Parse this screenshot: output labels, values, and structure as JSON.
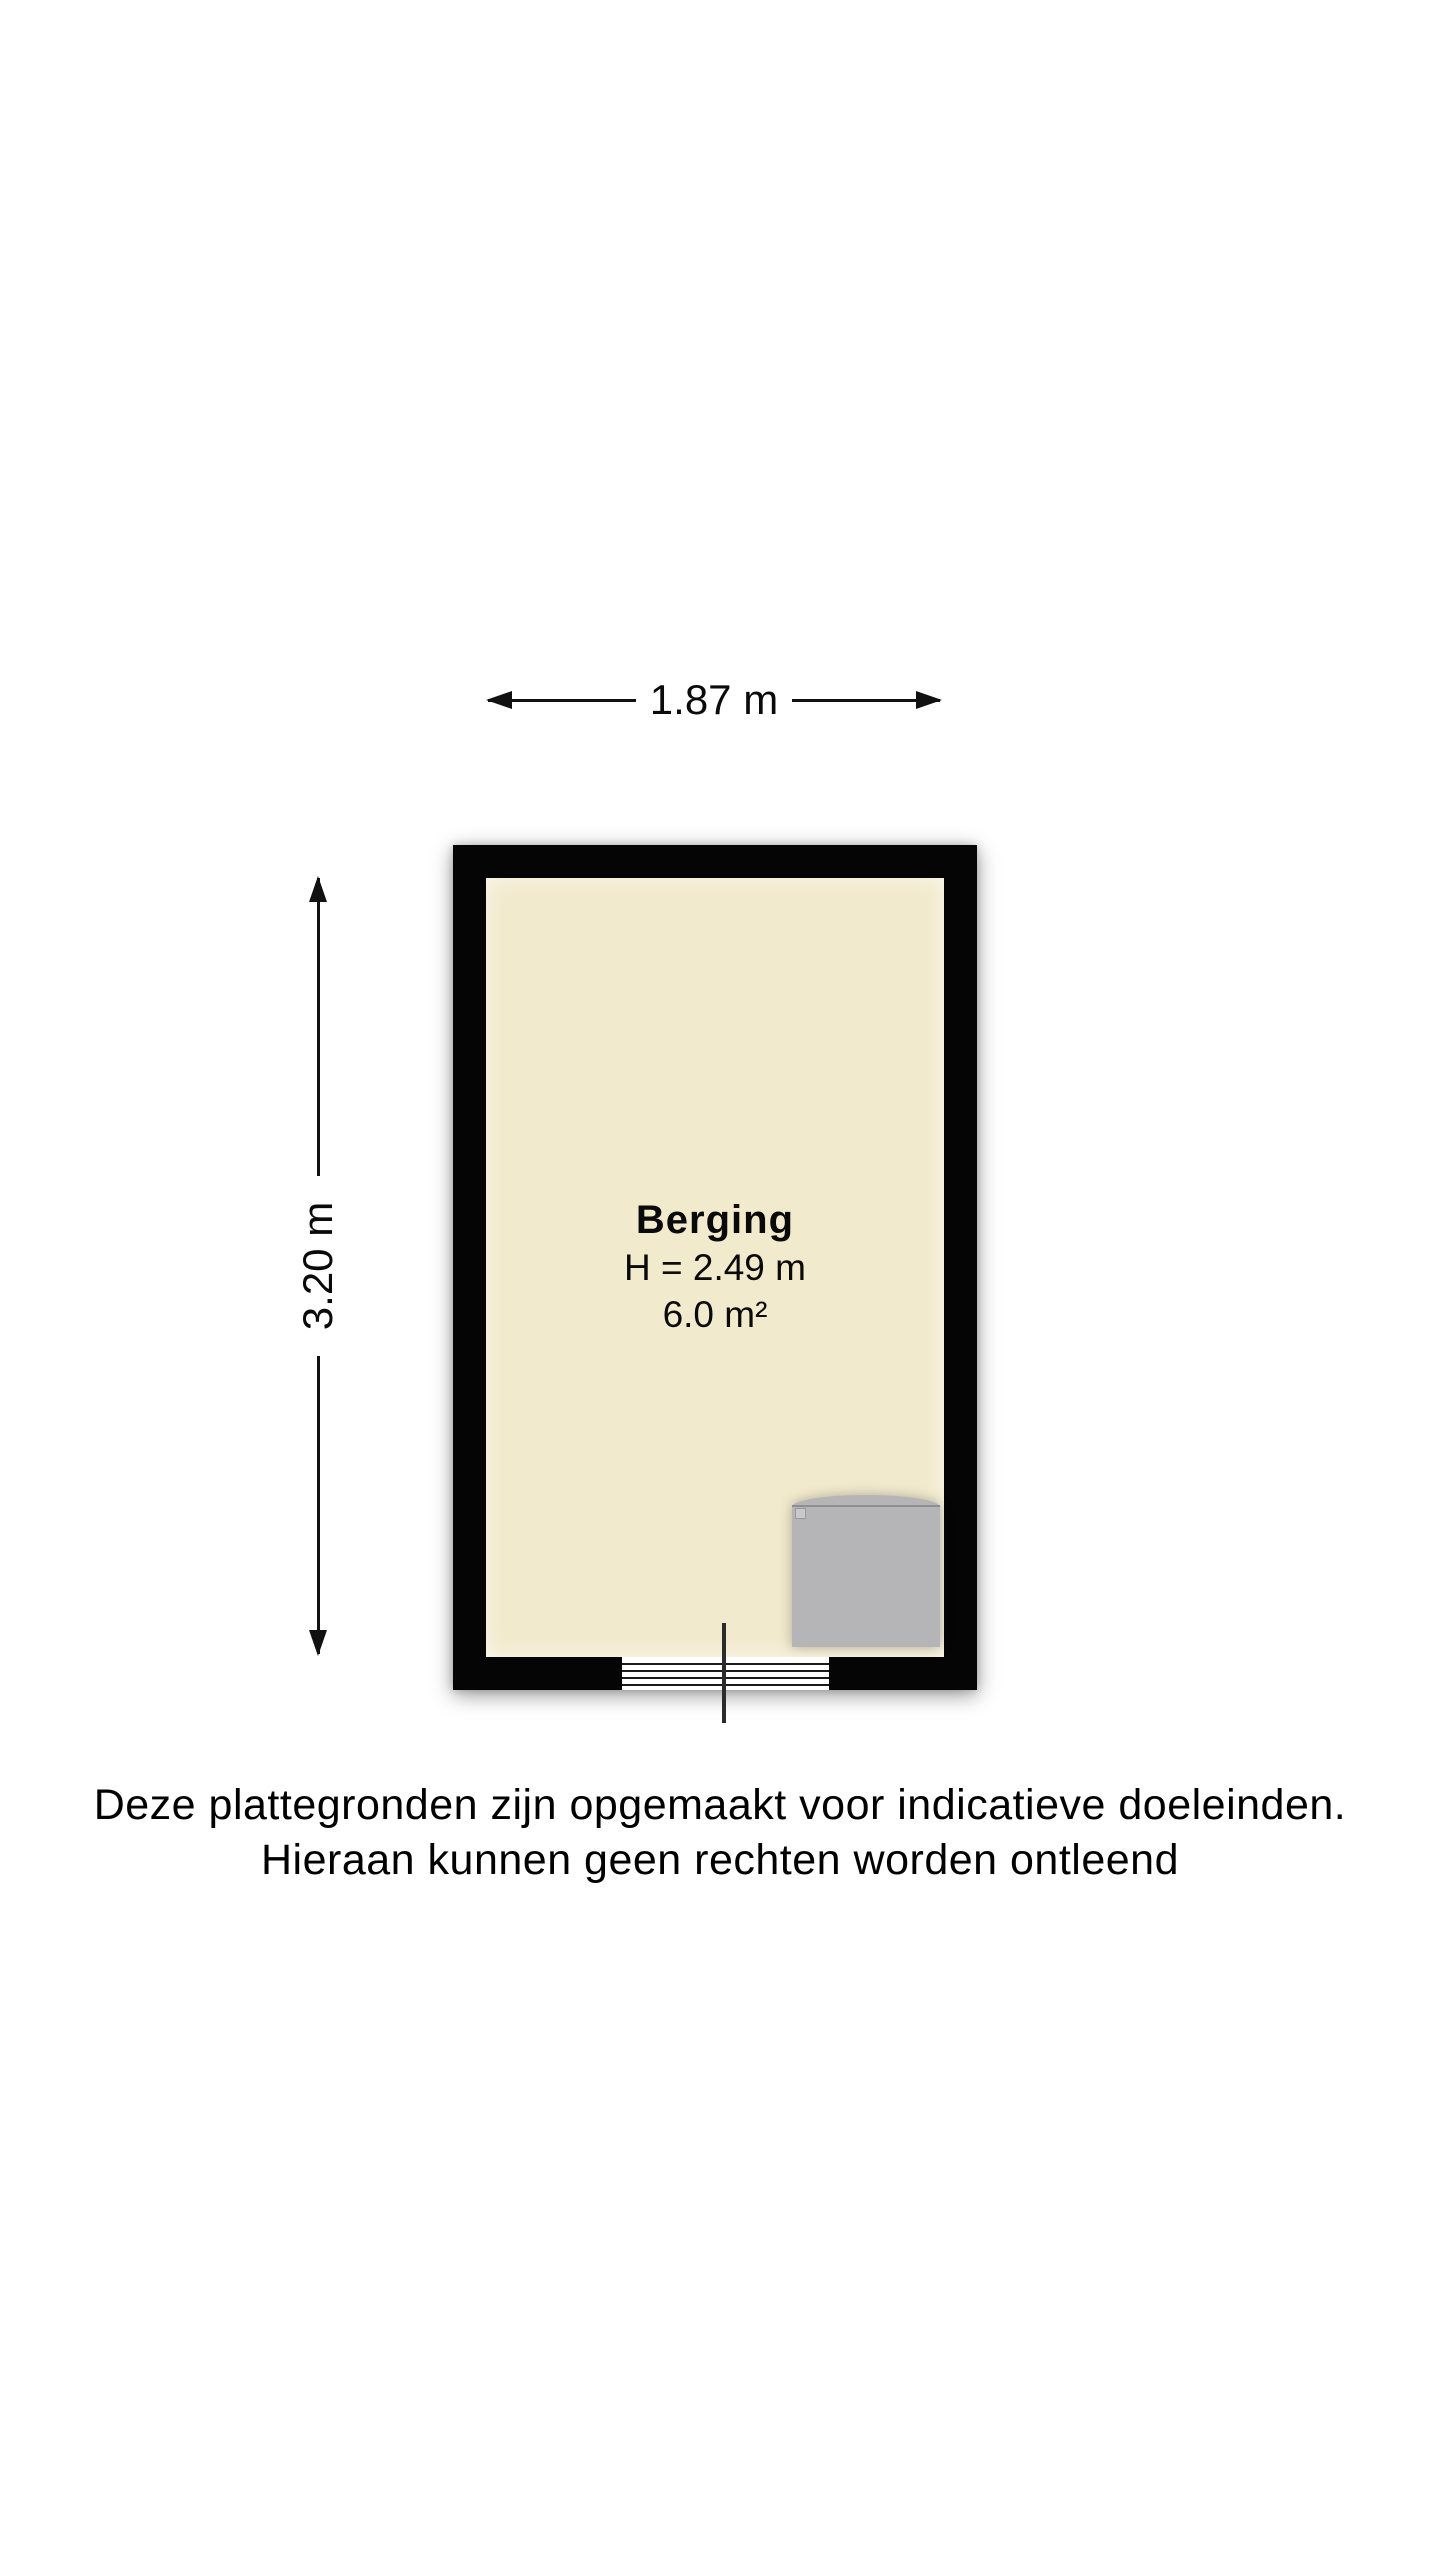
{
  "floorplan": {
    "room": {
      "name": "Berging",
      "ceiling_height_label": "H = 2.49 m",
      "area_label": "6.0 m²"
    },
    "dimensions": {
      "width_label": "1.87 m",
      "height_label": "3.20 m"
    },
    "colors": {
      "wall": "#050505",
      "floor": "#F2EACD",
      "appliance": "#B5B4B6",
      "background": "#FFFFFF"
    }
  },
  "disclaimer": {
    "line1": "Deze plattegronden zijn opgemaakt voor indicatieve doeleinden.",
    "line2": "Hieraan kunnen geen rechten worden ontleend"
  }
}
